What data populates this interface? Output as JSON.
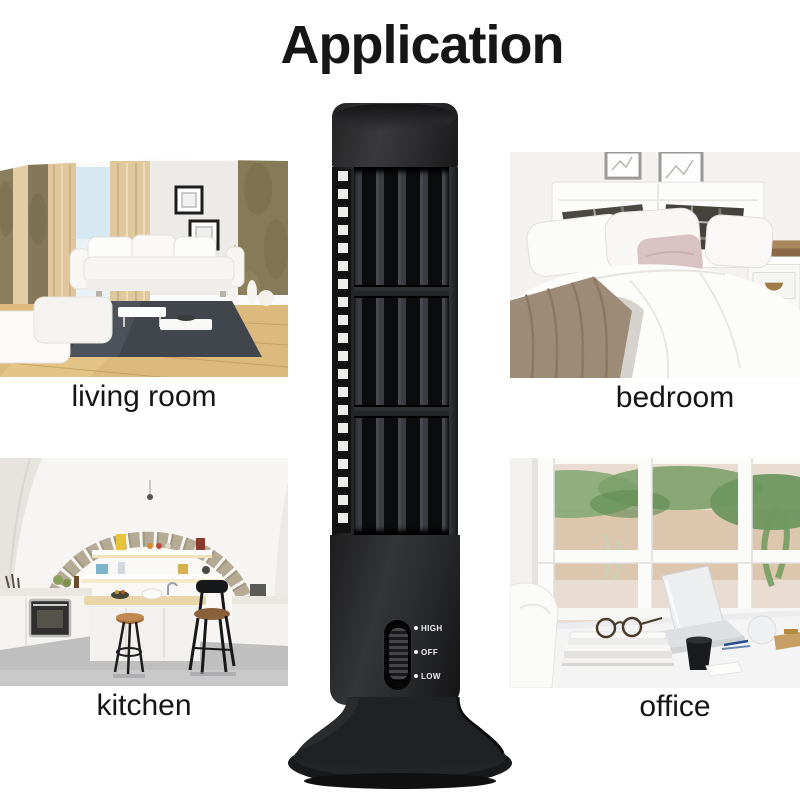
{
  "title": "Application",
  "rooms": [
    {
      "id": "living-room",
      "label": "living room"
    },
    {
      "id": "bedroom",
      "label": "bedroom"
    },
    {
      "id": "kitchen",
      "label": "kitchen"
    },
    {
      "id": "office",
      "label": "office"
    }
  ],
  "fan": {
    "name": "usb-tower-fan",
    "switch_labels": [
      "HIGH",
      "OFF",
      "LOW"
    ],
    "body_color": "#1f1f20",
    "switch_label_color": "#efefef"
  },
  "colors": {
    "background": "#ffffff",
    "title_text": "#161616",
    "caption_text": "#151515"
  }
}
